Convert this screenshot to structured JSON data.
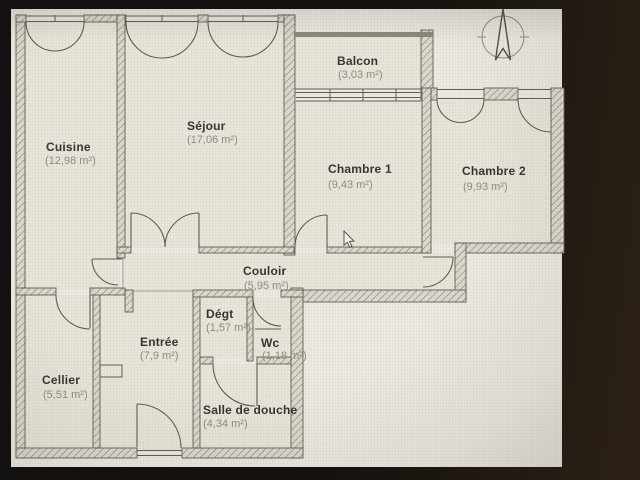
{
  "photo": {
    "kind": "photograph of a screen showing an apartment floor plan",
    "frame_color": "#17120e",
    "paper_color": "#edeae3",
    "wall_line_color": "#5f5b52",
    "room_name_color": "#33322e",
    "room_area_color": "#8e8b83"
  },
  "plan": {
    "rooms": [
      {
        "name": "Cuisine",
        "area": "(12,98 m²)"
      },
      {
        "name": "Séjour",
        "area": "(17,06 m²)"
      },
      {
        "name": "Balcon",
        "area": "(3,03 m²)"
      },
      {
        "name": "Chambre 1",
        "area": "(9,43 m²)"
      },
      {
        "name": "Chambre 2",
        "area": "(9,93 m²)"
      },
      {
        "name": "Couloir",
        "area": "(5,95 m²)"
      },
      {
        "name": "Dégt",
        "area": "(1,57 m²)"
      },
      {
        "name": "Wc",
        "area": "(1,18 m²)"
      },
      {
        "name": "Entrée",
        "area": "(7,9 m²)"
      },
      {
        "name": "Cellier",
        "area": "(5,51 m²)"
      },
      {
        "name": "Salle de douche",
        "area": "(4,34 m²)"
      }
    ],
    "compass": {
      "icon": "north-arrow"
    },
    "cursor": {
      "icon": "mouse-pointer",
      "x": 344,
      "y": 231
    }
  }
}
